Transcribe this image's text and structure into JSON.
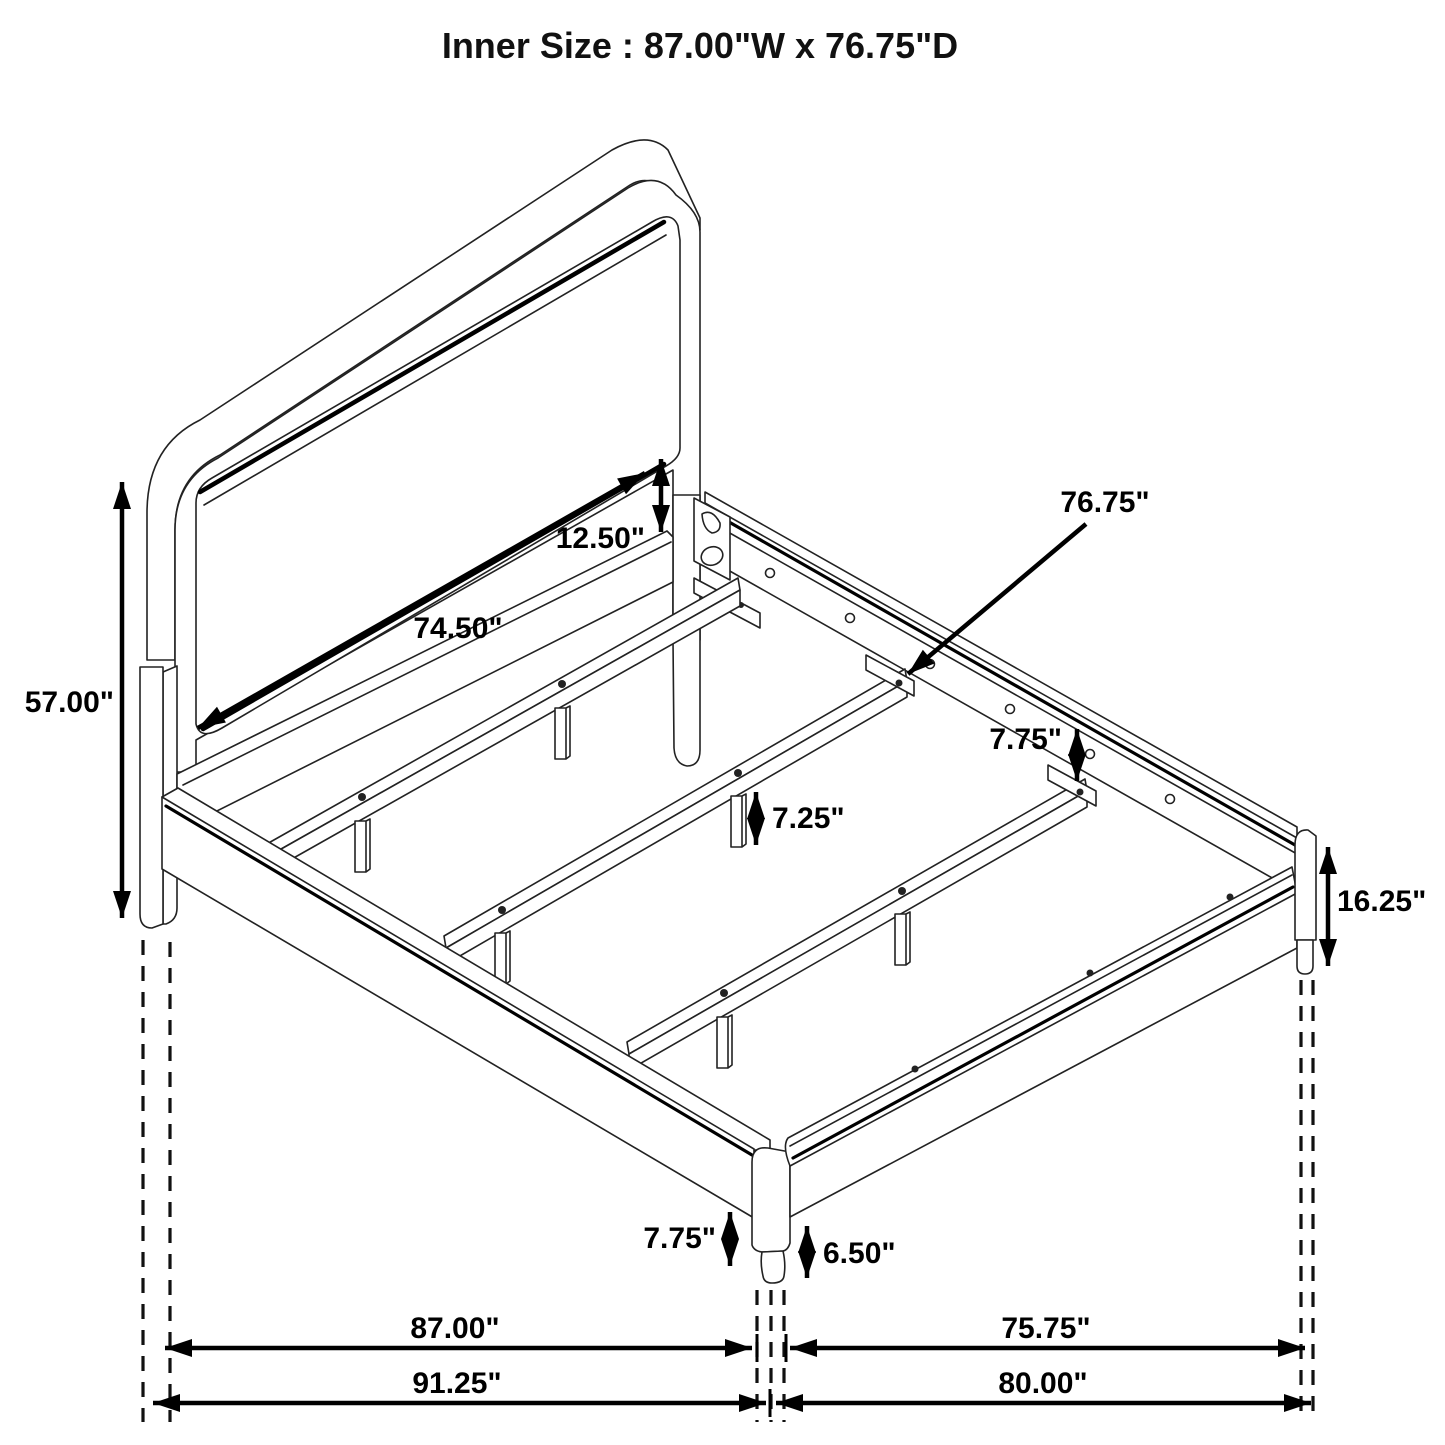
{
  "title": "Inner Size : 87.00\"W x 76.75\"D",
  "diagram": {
    "subject": "bed-frame-assembly-dimension-diagram",
    "colors": {
      "line": "#222222",
      "dimension": "#000000",
      "background": "#ffffff"
    },
    "labels": {
      "headboard_panel_width": "74.50\"",
      "panel_to_rail_gap": "12.50\"",
      "headboard_height": "57.00\"",
      "support_rail_length": "76.75\"",
      "side_rail_height": "7.75\"",
      "center_leg_height": "7.25\"",
      "footboard_corner_height": "16.25\"",
      "rail_floor_clearance": "7.75\"",
      "front_leg_height": "6.50\"",
      "inner_width": "87.00\"",
      "outer_width": "91.25\"",
      "inner_depth": "75.75\"",
      "outer_depth": "80.00\""
    }
  }
}
